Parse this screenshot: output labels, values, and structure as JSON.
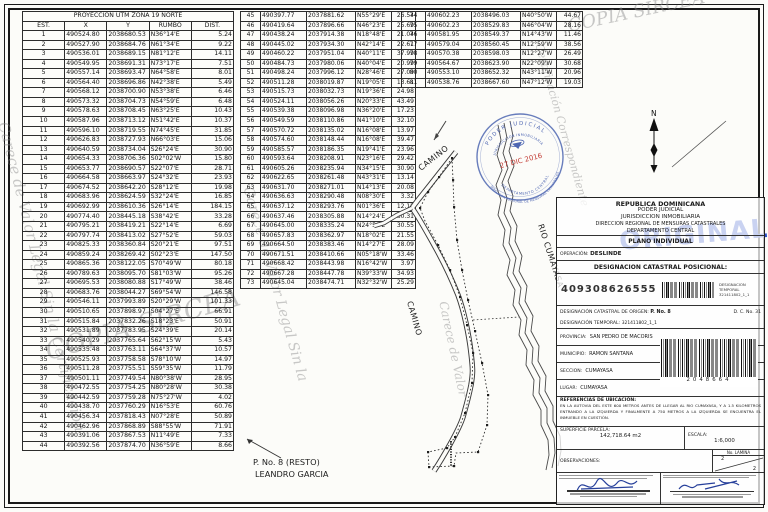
{
  "header": {
    "title": "PROYECCION UTM ZONA 19 NORTE",
    "columns": [
      "EST.",
      "X",
      "Y",
      "RUMBO",
      "DIST."
    ]
  },
  "tables": {
    "t1": [
      [
        "1",
        "490524.80",
        "2038680.53",
        "N36°14'E",
        "5.24"
      ],
      [
        "2",
        "490527.90",
        "2038684.76",
        "N61°34'E",
        "9.22"
      ],
      [
        "3",
        "490536.01",
        "2038689.15",
        "N81°12'E",
        "14.11"
      ],
      [
        "4",
        "490549.95",
        "2038691.31",
        "N73°17'E",
        "7.51"
      ],
      [
        "5",
        "490557.14",
        "2038693.47",
        "N64°58'E",
        "8.01"
      ],
      [
        "6",
        "490564.40",
        "2038696.86",
        "N42°38'E",
        "5.49"
      ],
      [
        "7",
        "490568.12",
        "2038700.90",
        "N53°38'E",
        "6.46"
      ],
      [
        "8",
        "490573.32",
        "2038704.73",
        "N54°59'E",
        "6.48"
      ],
      [
        "9",
        "490578.63",
        "2038708.45",
        "N63°25'E",
        "10.43"
      ],
      [
        "10",
        "490587.96",
        "2038713.12",
        "N51°42'E",
        "10.37"
      ],
      [
        "11",
        "490596.10",
        "2038719.55",
        "N74°45'E",
        "31.85"
      ],
      [
        "12",
        "490626.83",
        "2038727.93",
        "N66°03'E",
        "15.06"
      ],
      [
        "13",
        "490640.59",
        "2038734.04",
        "S26°24'E",
        "30.90"
      ],
      [
        "14",
        "490654.33",
        "2038706.36",
        "S02°02'W",
        "15.80"
      ],
      [
        "15",
        "490653.77",
        "2038690.57",
        "S22°07'E",
        "28.71"
      ],
      [
        "16",
        "490664.58",
        "2038663.97",
        "S24°32'E",
        "23.93"
      ],
      [
        "17",
        "490674.52",
        "2038642.20",
        "S28°12'E",
        "19.98"
      ],
      [
        "18",
        "490683.96",
        "2038624.59",
        "S32°24'E",
        "16.85"
      ],
      [
        "19",
        "490692.99",
        "2038610.36",
        "S26°14'E",
        "184.15"
      ],
      [
        "20",
        "490774.40",
        "2038445.18",
        "S38°42'E",
        "33.28"
      ],
      [
        "21",
        "490795.21",
        "2038419.21",
        "S22°14'E",
        "6.69"
      ],
      [
        "22",
        "490797.74",
        "2038413.02",
        "S27°52'E",
        "59.03"
      ],
      [
        "23",
        "490825.33",
        "2038360.84",
        "S20°21'E",
        "97.51"
      ],
      [
        "24",
        "490859.24",
        "2038269.42",
        "S02°23'E",
        "147.50"
      ],
      [
        "25",
        "490865.36",
        "2038122.05",
        "S70°49'W",
        "80.18"
      ],
      [
        "26",
        "490789.63",
        "2038095.70",
        "S81°03'W",
        "95.26"
      ],
      [
        "27",
        "490695.53",
        "2038080.88",
        "S17°49'W",
        "38.46"
      ],
      [
        "28",
        "490683.76",
        "2038044.27",
        "S69°54'W",
        "146.58"
      ],
      [
        "29",
        "490546.11",
        "2037993.89",
        "S20°29'W",
        "101.33"
      ],
      [
        "30",
        "490510.65",
        "2037898.97",
        "S04°27'E",
        "66.91"
      ],
      [
        "31",
        "490515.84",
        "2037832.26",
        "S18°23'E",
        "50.91"
      ],
      [
        "32",
        "490531.89",
        "2037783.95",
        "S24°39'E",
        "20.14"
      ],
      [
        "33",
        "490540.29",
        "2037765.64",
        "S62°15'W",
        "5.43"
      ],
      [
        "34",
        "490535.48",
        "2037763.11",
        "S64°37'W",
        "10.57"
      ],
      [
        "35",
        "490525.93",
        "2037758.58",
        "S78°10'W",
        "14.97"
      ],
      [
        "36",
        "490511.28",
        "2037755.51",
        "S59°35'W",
        "11.79"
      ],
      [
        "37",
        "490501.11",
        "2037749.54",
        "N80°38'W",
        "28.95"
      ],
      [
        "38",
        "490472.55",
        "2037754.25",
        "N80°28'W",
        "30.38"
      ],
      [
        "39",
        "490442.59",
        "2037759.28",
        "N75°27'W",
        "4.02"
      ],
      [
        "40",
        "490438.70",
        "2037760.29",
        "N16°53'E",
        "60.76"
      ],
      [
        "41",
        "490456.34",
        "2037818.43",
        "N07°28'E",
        "50.89"
      ],
      [
        "42",
        "490462.96",
        "2037868.89",
        "S88°55'W",
        "71.91"
      ],
      [
        "43",
        "490391.06",
        "2037867.53",
        "N11°49'E",
        "7.33"
      ],
      [
        "44",
        "490392.56",
        "2037874.70",
        "N36°59'E",
        "8.66"
      ]
    ],
    "t2": [
      [
        "45",
        "490397.77",
        "2037881.62",
        "N55°29'E",
        "26.54"
      ],
      [
        "46",
        "490419.64",
        "2037896.66",
        "N46°23'E",
        "25.69"
      ],
      [
        "47",
        "490438.24",
        "2037914.38",
        "N18°48'E",
        "21.04"
      ],
      [
        "48",
        "490445.02",
        "2037934.30",
        "N42°14'E",
        "22.61"
      ],
      [
        "49",
        "490460.22",
        "2037951.04",
        "N40°11'E",
        "37.99"
      ],
      [
        "50",
        "490484.73",
        "2037980.06",
        "N40°04'E",
        "20.99"
      ],
      [
        "51",
        "490498.24",
        "2037996.12",
        "N28°46'E",
        "27.09"
      ],
      [
        "52",
        "490511.28",
        "2038019.87",
        "N19°05'E",
        "13.61"
      ],
      [
        "53",
        "490515.73",
        "2038032.73",
        "N19°36'E",
        "24.98"
      ],
      [
        "54",
        "490524.11",
        "2038056.26",
        "N20°33'E",
        "43.49"
      ],
      [
        "55",
        "490539.38",
        "2038096.98",
        "N36°20'E",
        "17.23"
      ],
      [
        "56",
        "490549.59",
        "2038110.86",
        "N41°10'E",
        "32.10"
      ],
      [
        "57",
        "490570.72",
        "2038135.02",
        "N16°08'E",
        "13.97"
      ],
      [
        "58",
        "490574.60",
        "2038148.44",
        "N16°08'E",
        "39.47"
      ],
      [
        "59",
        "490585.57",
        "2038186.35",
        "N19°41'E",
        "23.96"
      ],
      [
        "60",
        "490593.64",
        "2038208.91",
        "N23°16'E",
        "29.42"
      ],
      [
        "61",
        "490605.26",
        "2038235.94",
        "N34°15'E",
        "30.90"
      ],
      [
        "62",
        "490622.65",
        "2038261.48",
        "N43°31'E",
        "13.14"
      ],
      [
        "63",
        "490631.70",
        "2038271.01",
        "N14°13'E",
        "20.08"
      ],
      [
        "64",
        "490636.63",
        "2038290.48",
        "N08°30'E",
        "3.32"
      ],
      [
        "65",
        "490637.12",
        "2038293.76",
        "N01°36'E",
        "12.12"
      ],
      [
        "66",
        "490637.46",
        "2038305.88",
        "N14°24'E",
        "30.31"
      ],
      [
        "67",
        "490645.00",
        "2038335.24",
        "N24°50'E",
        "30.55"
      ],
      [
        "68",
        "490657.83",
        "2038362.97",
        "N18°02'E",
        "21.55"
      ],
      [
        "69",
        "490664.50",
        "2038383.46",
        "N14°27'E",
        "28.09"
      ],
      [
        "70",
        "490671.51",
        "2038410.66",
        "N05°18'W",
        "33.46"
      ],
      [
        "71",
        "490668.42",
        "2038443.98",
        "N16°42'W",
        "3.97"
      ],
      [
        "72",
        "490667.28",
        "2038447.78",
        "N39°33'W",
        "34.93"
      ],
      [
        "73",
        "490645.04",
        "2038474.71",
        "N32°32'W",
        "25.29"
      ]
    ],
    "t3": [
      [
        "74",
        "490602.23",
        "2038496.03",
        "N40°50'W",
        "44.67"
      ],
      [
        "75",
        "490602.23",
        "2038529.83",
        "N46°04'W",
        "28.16"
      ],
      [
        "76",
        "490581.95",
        "2038549.37",
        "N14°43'W",
        "11.46"
      ],
      [
        "77",
        "490579.04",
        "2038560.45",
        "N12°59'W",
        "38.56"
      ],
      [
        "78",
        "490570.38",
        "2038598.03",
        "N12°27'W",
        "26.49"
      ],
      [
        "79",
        "490564.67",
        "2038623.90",
        "N22°09'W",
        "30.68"
      ],
      [
        "80",
        "490553.10",
        "2038652.32",
        "N43°11'W",
        "20.96"
      ],
      [
        "81",
        "490538.76",
        "2038667.60",
        "N47°12'W",
        "19.03"
      ]
    ]
  },
  "map": {
    "north_label": "N",
    "labels": {
      "camino_top": "CAMINO",
      "camino_side": "CAMINO",
      "rio": "RIO CUMAYASA",
      "parcel_line1": "P. No. 8 (RESTO)",
      "parcel_line2": "LEANDRO GARCIA"
    },
    "stamp": {
      "arc_top": "PODER JUDICIAL",
      "arc_inner": "JURISDICCION INMOBILIARIA",
      "date": "27 DIC 2016",
      "arc_bottom1": "DEPARTAMENTO CENTRAL",
      "arc_bottom2": "DIRECCION REGIONAL DE MENSURAS CATASTRALES",
      "ring_color": "#4e66b2",
      "date_color": "#c23b34"
    }
  },
  "original_stamp": {
    "text": "ORIGINAL",
    "color": "#2b4ec5"
  },
  "watermarks": {
    "copia": "COPIA SIRCEA",
    "carece1": "Carece de Valor Legal Sin la Certificación",
    "carece2": "Certificación Correspondiente",
    "carece3": "Carece de Valor Legal Sin la",
    "carece4": "Carece de Valor"
  },
  "titleblock": {
    "line1": "REPUBLICA DOMINICANA",
    "line2": "PODER JUDICIAL",
    "line3": "JURISDICCION INMOBILIARIA",
    "line4": "DIRECCION REGIONAL DE MENSURAS CATASTRALES",
    "line5": "DEPARTAMENTO CENTRAL",
    "plano": "PLANO INDIVIDUAL",
    "operacion_label": "OPERACIÓN:",
    "operacion_value": "DESLINDE",
    "desig_pos_label": "DESIGNACION CATASTRAL POSICIONAL:",
    "desig_pos_value": "409308626555",
    "desig_temp_small_label": "DESIGNACION TEMPORAL",
    "desig_temp_small_value": "321411802_1_1",
    "origen_label": "DESIGNACIÓN CATASTRAL DE ORIGEN:",
    "origen_value": "P. No. 8",
    "dc": "D. C. No. 31",
    "temporal_label": "DESIGNACIÓN TEMPORAL:",
    "temporal_value": "321411802_1_1",
    "provincia_label": "PROVINCIA:",
    "provincia_value": "SAN PEDRO DE MACORIS",
    "municipio_label": "MUNICIPIO:",
    "municipio_value": "RAMON SANTANA",
    "seccion_label": "SECCION:",
    "seccion_value": "CUMAYASA",
    "lugar_label": "LUGAR:",
    "lugar_value": "CUMAYASA",
    "barcode_number": "2048664",
    "referencias_label": "REFERENCIAS DE UBICACIÓN:",
    "referencias_text": "EN LA AUTOVIA DEL ESTE 600 METROS ANTES DE LLEGAR AL RIO CUMAYASA, Y A 1.5 KILOMETROS ENTRANDO A LA IZQUIERDA Y FINALMENTE A 750 METROS A LA IZQUIERDA SE ENCUENTRA EL INMUEBLE EN CUESTIÓN.",
    "superficie_label": "SUPERFICIE PARCELA:",
    "superficie_value": "142,718.64 m2",
    "escala_label": "ESCALA:",
    "escala_value": "1:6,000",
    "observaciones_label": "OBSERVACIONES:",
    "lamina_label": "No. LAMINA",
    "lamina_top": "2",
    "lamina_bottom": "2"
  }
}
